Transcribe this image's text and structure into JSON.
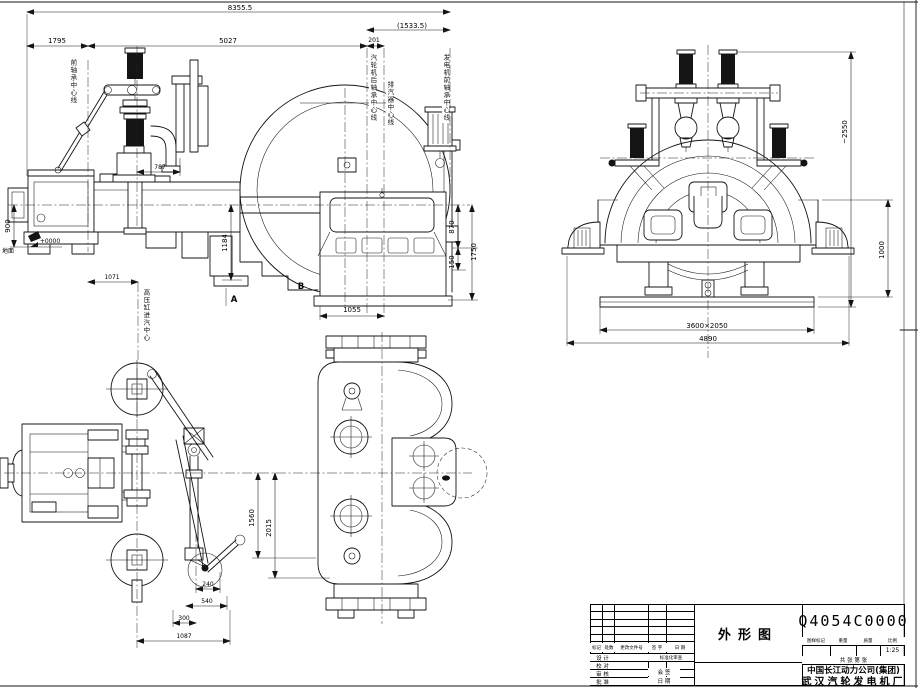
{
  "views": {
    "side": {
      "dims": {
        "overall": "8355.5",
        "right_group": "(1533.5)",
        "front": "1795",
        "mid": "5027",
        "rear": "201",
        "valve": "787",
        "height_mid": "1184",
        "left_height": "900",
        "level": "+0000",
        "ground": "地面",
        "base_front": "1071",
        "cond_upper": "870",
        "cond_lower": "150",
        "cond_total": "1750",
        "cond_width": "1055"
      },
      "markers": {
        "a": "A",
        "b": "B"
      },
      "labels": {
        "front_bearing": "前轴承中心线",
        "turbine_rear_bearing": "汽轮机后轴承中心线",
        "exhaust": "排汽器中心线",
        "generator_front_bearing": "发电机前轴承中心线",
        "hp_inlet": "高压缸进汽中心"
      }
    },
    "end": {
      "dims": {
        "height": "~2550",
        "upper": "1000",
        "base_pad": "3600×2050",
        "base_overall": "4890"
      }
    },
    "plan": {
      "dims": {
        "v1": "1560",
        "v2": "2015",
        "h1": "240",
        "h2": "540",
        "h3": "300",
        "h4": "1087"
      }
    }
  },
  "title_block": {
    "drawing_no": "Q4054C0000",
    "title": "外形图",
    "scale": "1:25",
    "company_line1": "中国长江动力公司(集团)",
    "company_line2": "武汉汽轮发电机厂",
    "rev_headers": {
      "mark": "标记",
      "count": "处数",
      "doc_no": "更改文件号",
      "sign": "签 字",
      "date": "日 期"
    },
    "roles": {
      "r1": "设 计",
      "r2": "校 对",
      "r3": "审 核",
      "r4": "批 准"
    },
    "mid": {
      "std": "标准化审查",
      "countersign": "会 签",
      "date": "日 期"
    },
    "info": {
      "c1": "图样标记",
      "c2": "重量",
      "c3": "质量",
      "c4": "比例"
    },
    "sheets": "共  张  第  张"
  }
}
